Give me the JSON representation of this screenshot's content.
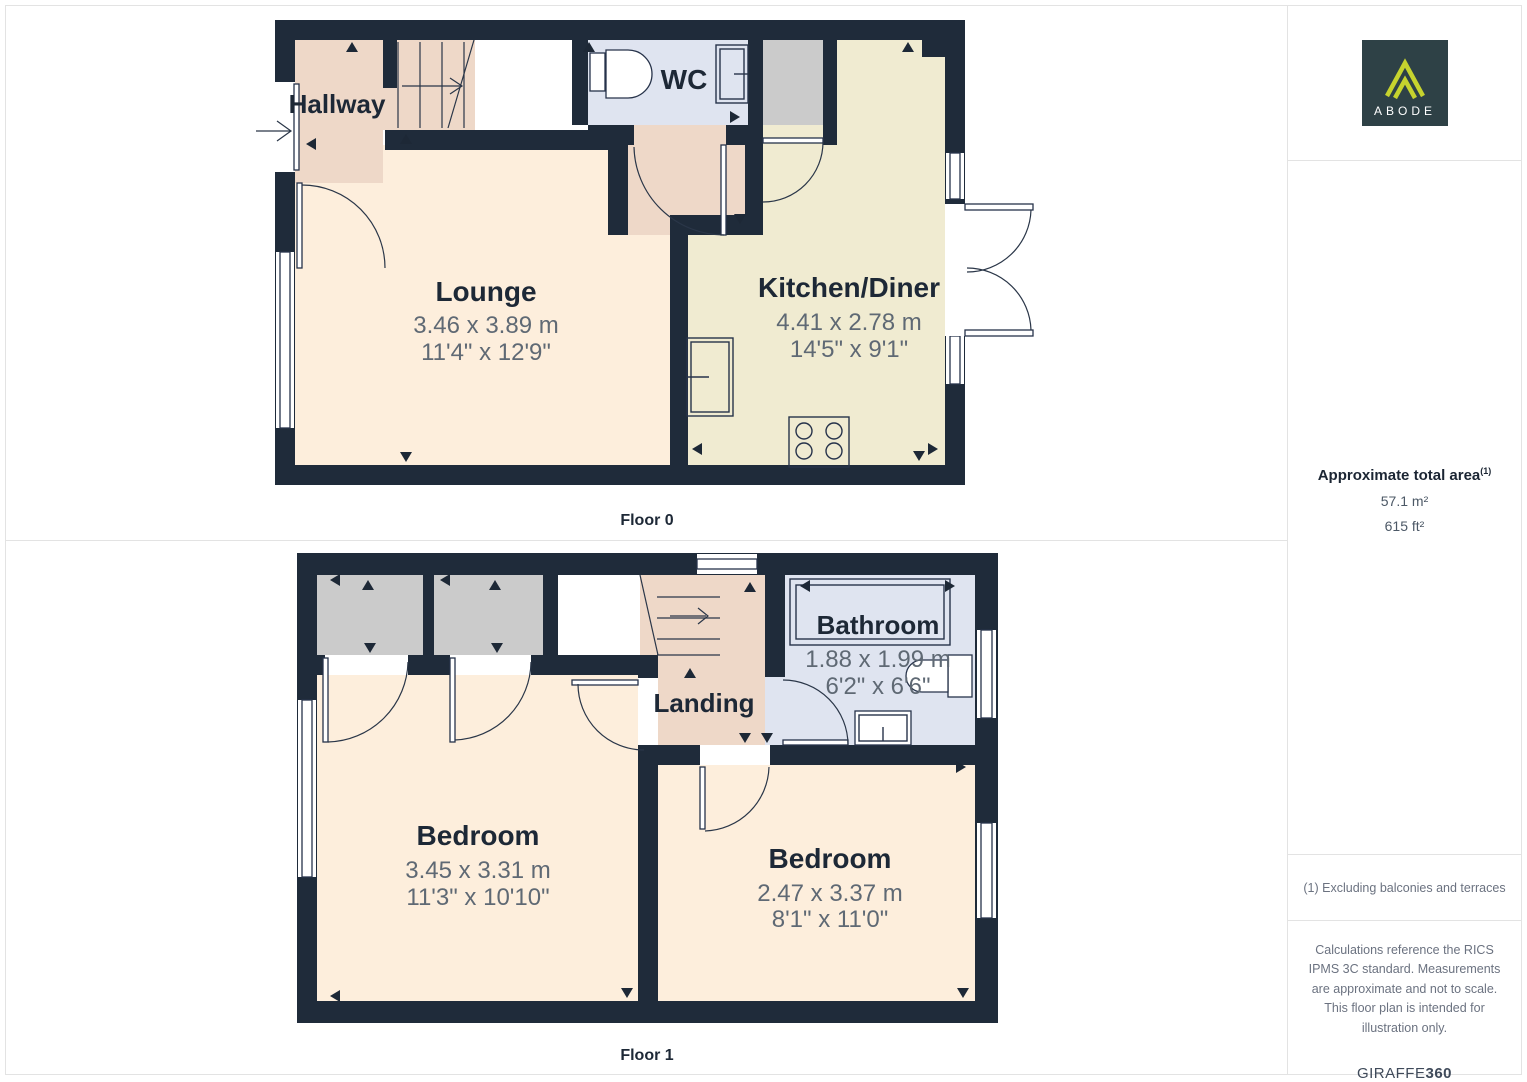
{
  "branding": {
    "logo_text": "ABODE"
  },
  "floors": {
    "f0": {
      "label": "Floor 0",
      "rooms": {
        "hallway": {
          "name": "Hallway"
        },
        "wc": {
          "name": "WC"
        },
        "lounge": {
          "name": "Lounge",
          "dims_m": "3.46 x 3.89 m",
          "dims_ft": "11'4\" x 12'9\""
        },
        "kitchen": {
          "name": "Kitchen/Diner",
          "dims_m": "4.41 x 2.78 m",
          "dims_ft": "14'5\" x 9'1\""
        }
      }
    },
    "f1": {
      "label": "Floor 1",
      "rooms": {
        "landing": {
          "name": "Landing"
        },
        "bathroom": {
          "name": "Bathroom",
          "dims_m": "1.88 x 1.99 m",
          "dims_ft": "6'2\" x 6'6\""
        },
        "bedroom_left": {
          "name": "Bedroom",
          "dims_m": "3.45 x 3.31 m",
          "dims_ft": "11'3\" x 10'10\""
        },
        "bedroom_right": {
          "name": "Bedroom",
          "dims_m": "2.47 x 3.37 m",
          "dims_ft": "8'1\" x 11'0\""
        }
      }
    }
  },
  "sidebar": {
    "area_title": "Approximate total area",
    "area_footnote_marker": "(1)",
    "area_m2": "57.1 m²",
    "area_ft2": "615 ft²",
    "footnote": "(1) Excluding balconies and terraces",
    "disclaimer": "Calculations reference the RICS IPMS 3C standard. Measurements are approximate and not to scale. This floor plan is intended for illustration only.",
    "brand_name": "GIRAFFE",
    "brand_suffix": "360"
  },
  "colors": {
    "wall": "#1f2b3a",
    "room_main": "#fdeedc",
    "room_hall": "#eed8c8",
    "room_wet": "#dfe4f0",
    "room_kitchen": "#f0ebd1",
    "room_storage": "#cbcbcb",
    "logo_bg": "#2e4146",
    "logo_accent": "#c6d32e",
    "dims_text": "#5f6974",
    "name_text": "#1d2836"
  }
}
